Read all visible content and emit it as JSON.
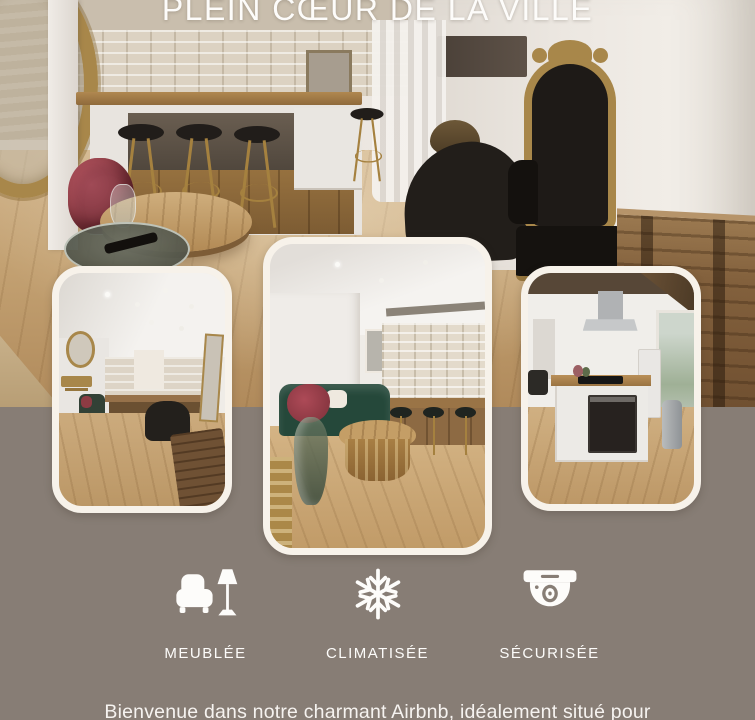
{
  "title": "PLEIN CŒUR DE LA VILLE",
  "features": [
    {
      "icon": "armchair-lamp-icon",
      "label": "MEUBLÉE"
    },
    {
      "icon": "snowflake-icon",
      "label": "CLIMATISÉE"
    },
    {
      "icon": "security-camera-icon",
      "label": "SÉCURISÉE"
    }
  ],
  "intro_text": "Bienvenue dans notre charmant Airbnb, idéalement situé pour",
  "colors": {
    "background": "#877d75",
    "text": "#fdfcfa",
    "card_border": "#f7f2ea",
    "gold_accent": "#a8874a",
    "wood_floor": "#c3a172"
  }
}
